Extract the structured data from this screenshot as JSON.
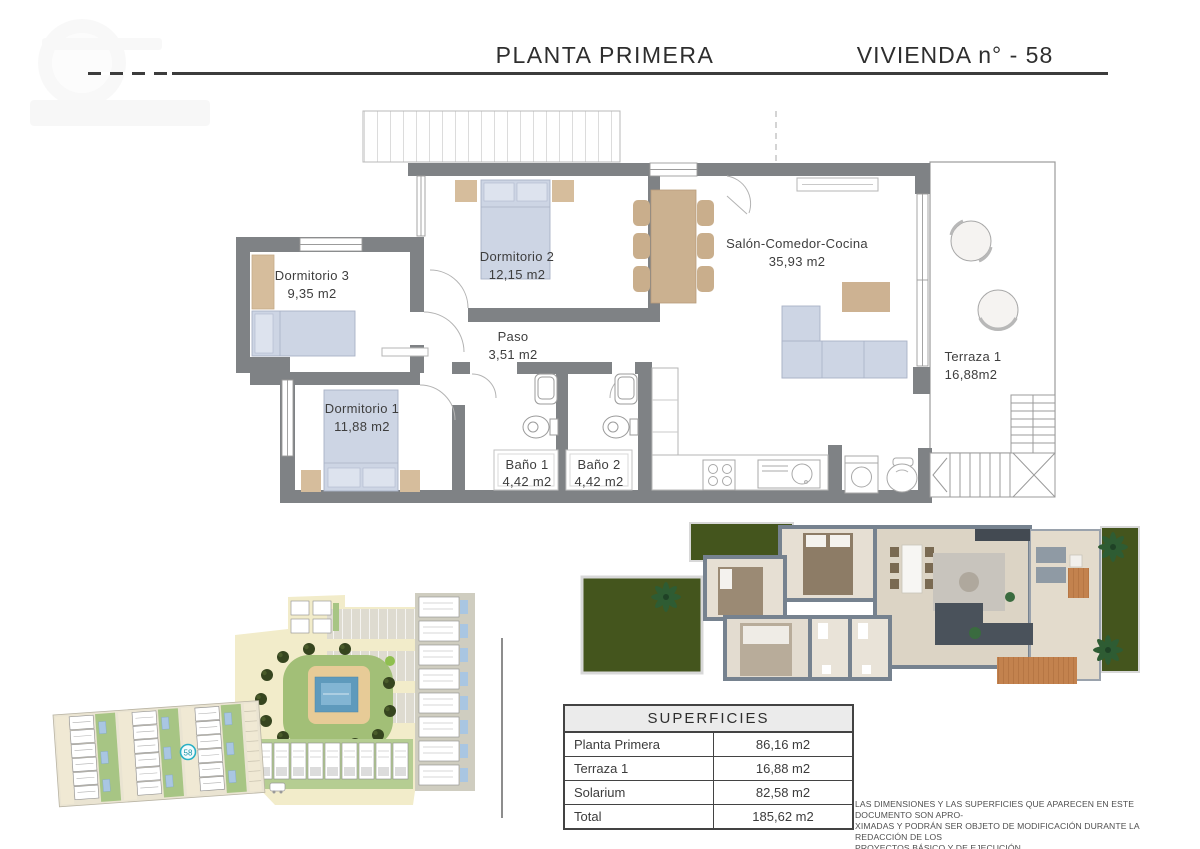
{
  "header": {
    "title": "PLANTA PRIMERA",
    "unit": "VIVIENDA n° - 58"
  },
  "plan": {
    "rooms": [
      {
        "name": "Dormitorio 3",
        "area": "9,35 m2"
      },
      {
        "name": "Dormitorio 2",
        "area": "12,15 m2"
      },
      {
        "name": "Paso",
        "area": "3,51 m2"
      },
      {
        "name": "Dormitorio 1",
        "area": "11,88 m2"
      },
      {
        "name": "Baño 1",
        "area": "4,42 m2"
      },
      {
        "name": "Baño 2",
        "area": "4,42 m2"
      },
      {
        "name": "Salón-Comedor-Cocina",
        "area": "35,93 m2"
      },
      {
        "name": "Terraza 1",
        "area": "16,88m2"
      }
    ]
  },
  "site_plan": {
    "unit_marker": "58"
  },
  "surfaces_table": {
    "title": "SUPERFICIES",
    "rows": [
      {
        "label": "Planta Primera",
        "value": "86,16 m2"
      },
      {
        "label": "Terraza 1",
        "value": "16,88 m2"
      },
      {
        "label": "Solarium",
        "value": "82,58 m2"
      },
      {
        "label": "Total",
        "value": "185,62 m2"
      }
    ]
  },
  "disclaimer": {
    "lines": [
      "LAS DIMENSIONES Y LAS SUPERFICIES QUE APARECEN EN ESTE DOCUMENTO SON APRO-",
      "XIMADAS Y PODRÁN SER OBJETO DE MODIFICACIÓN DURANTE LA REDACCIÓN DE LOS",
      "PROYECTOS BÁSICO Y DE EJECUCIÓN"
    ]
  },
  "colors": {
    "marker_teal": "#29b0c5",
    "wall_gray": "#7f8285",
    "furniture_blue": "#ccd4e3",
    "furniture_tan": "#d3ba99",
    "pool_blue": "#5e9abc",
    "grass_green": "#44551d",
    "site_green": "#a7c584",
    "site_cream": "#f2ecca"
  }
}
